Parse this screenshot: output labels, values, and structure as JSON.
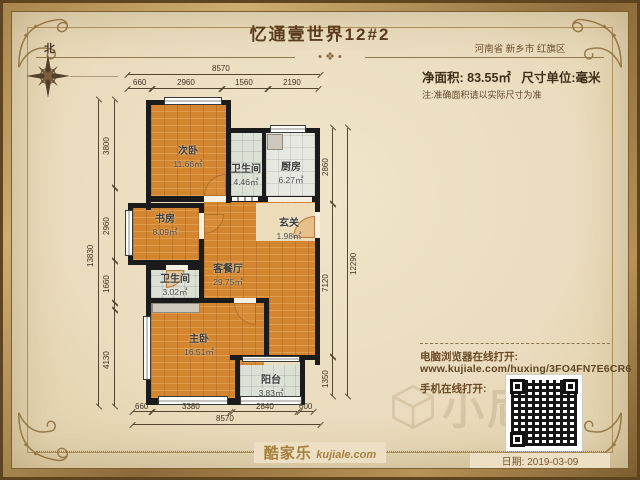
{
  "title": "忆通壹世界12#2",
  "divider_ornament": "• ❖ •",
  "header": {
    "location": "河南省 新乡市 红旗区",
    "area": "净面积:  83.55㎡",
    "unit": "尺寸单位:毫米",
    "note": "注:准确面积请以实际尺寸为准"
  },
  "compass": {
    "label": "北"
  },
  "rooms": [
    {
      "name": "次卧",
      "area": "11.66㎡"
    },
    {
      "name": "卫生间",
      "area": "4.46㎡"
    },
    {
      "name": "厨房",
      "area": "6.27㎡"
    },
    {
      "name": "书房",
      "area": "8.09㎡"
    },
    {
      "name": "玄关",
      "area": "1.98㎡"
    },
    {
      "name": "客餐厅",
      "area": "29.75㎡"
    },
    {
      "name": "卫生间",
      "area": "3.02㎡"
    },
    {
      "name": "主卧",
      "area": "16.51㎡"
    },
    {
      "name": "阳台",
      "area": "3.83㎡"
    }
  ],
  "dims": {
    "top_total": "8570",
    "top": [
      "660",
      "2960",
      "1560",
      "2190"
    ],
    "bottom_total": "8570",
    "bottom": [
      "660",
      "3380",
      "2840",
      "600"
    ],
    "left_total": "13830",
    "left": [
      "3800",
      "2960",
      "1660",
      "4130"
    ],
    "right_total": "12290",
    "right": [
      "2860",
      "7120",
      "1350"
    ]
  },
  "share": {
    "desktop_label": "电脑浏览器在线打开:",
    "url": "www.kujiale.com/huxing/3FO4FN7E6CR6",
    "mobile_label": "手机在线打开:"
  },
  "watermark_text": "小尼",
  "footer": {
    "brand": "酷家乐",
    "brand_domain": "kujiale.com",
    "date": "日期: 2019-03-09"
  },
  "colors": {
    "wood_floor": "#d3862f",
    "tile_floor": "#dce1d6",
    "wall": "#1b1b1b",
    "accent_gold": "#a5803f",
    "parchment": "#ecdfc3",
    "text_brown": "#5a3c1e"
  }
}
